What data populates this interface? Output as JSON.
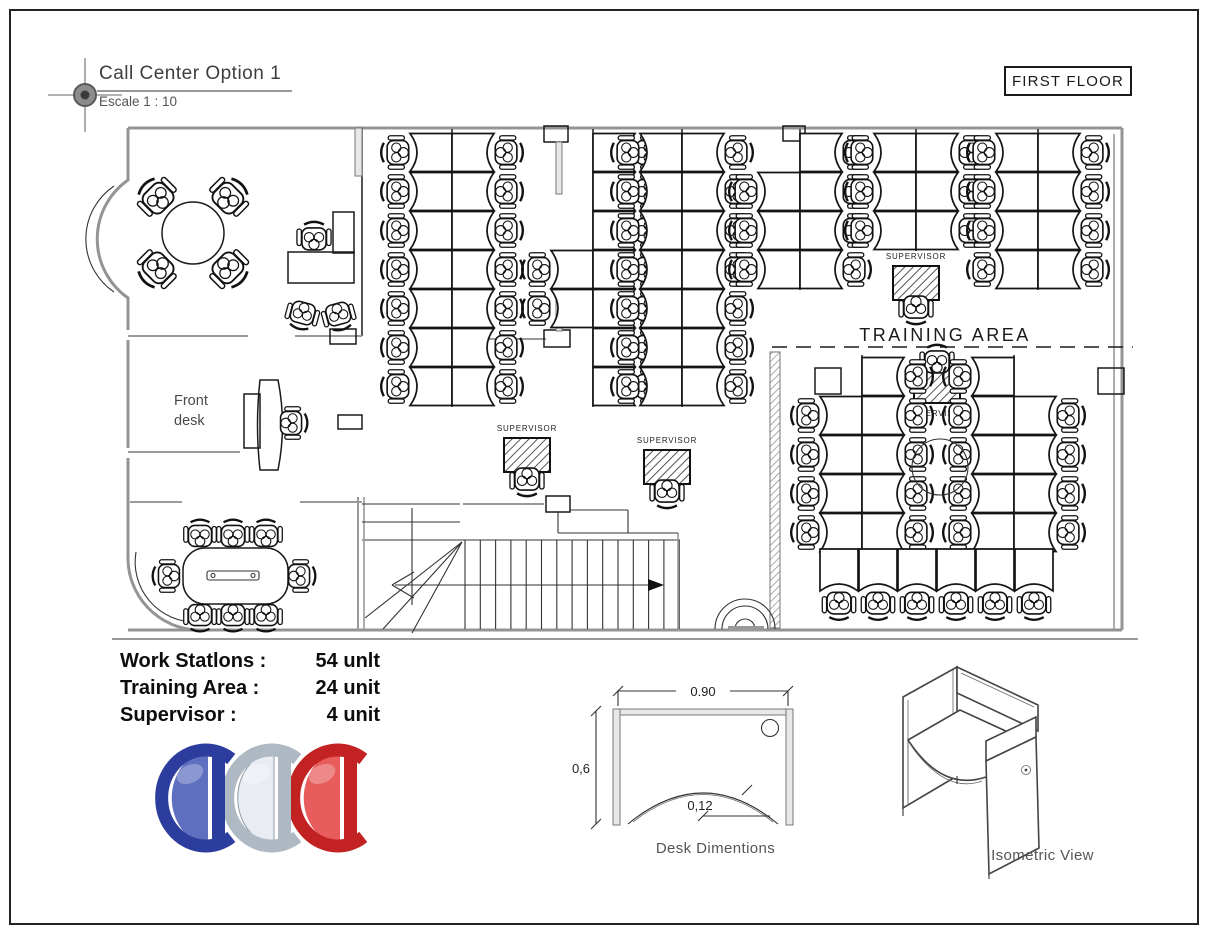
{
  "meta": {
    "title": "Call Center Option 1",
    "scale_label": "Escale 1 : 10",
    "floor_label": "FIRST FLOOR"
  },
  "floorplan": {
    "front_desk_line1": "Front",
    "front_desk_line2": "desk",
    "training_area_label": "TRAINING AREA",
    "supervisor_label": "SUPERVISOR"
  },
  "legend": {
    "rows": [
      {
        "label": "Work Statlons :",
        "value": "54 unlt"
      },
      {
        "label": "Training Area :",
        "value": "24 unit"
      },
      {
        "label": "Supervisor :",
        "value": "4 unit"
      }
    ]
  },
  "desk_diagram": {
    "caption": "Desk Dimentions",
    "width_label": "0.90",
    "depth_label": "0,6",
    "cutout_label": "0,12"
  },
  "isometric": {
    "caption": "Isometric View"
  },
  "logo": {
    "letters": [
      "C",
      "C",
      "C"
    ],
    "colors": {
      "blue": "#5f6fc0",
      "blue_dark": "#2c3d9e",
      "silver": "#e9edf3",
      "silver_dark": "#aeb9c4",
      "red": "#e85c5c",
      "red_dark": "#c32222"
    }
  }
}
